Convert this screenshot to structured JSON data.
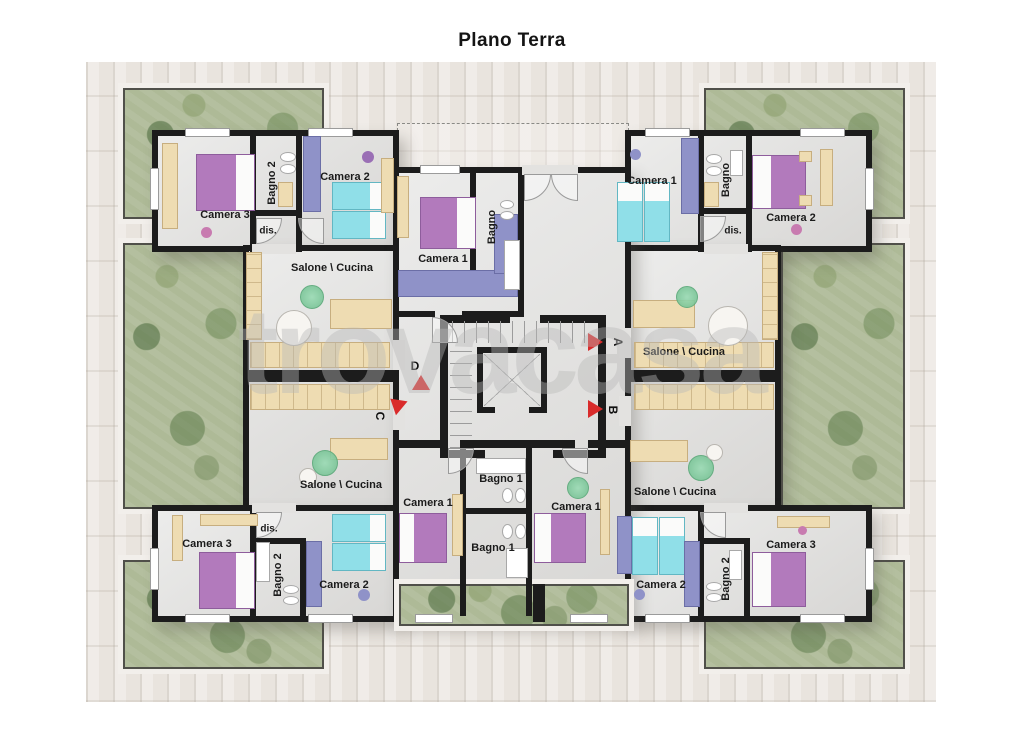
{
  "title": "Plano Terra",
  "watermark": "trovacasa",
  "markers": {
    "a": "A",
    "b": "B",
    "c": "C",
    "d": "D"
  },
  "rooms": {
    "top_left": {
      "camera3": "Camera 3",
      "bagno2": "Bagno 2",
      "camera2": "Camera 2",
      "dis": "dis.",
      "salone": "Salone \\ Cucina"
    },
    "top_center": {
      "camera1": "Camera 1",
      "bagno": "Bagno"
    },
    "top_right": {
      "camera1": "Camera 1",
      "bagno": "Bagno",
      "camera2": "Camera 2",
      "dis": "dis.",
      "salone": "Salone \\ Cucina"
    },
    "bottom_left": {
      "salone": "Salone \\ Cucina",
      "dis": "dis.",
      "camera3": "Camera 3",
      "bagno2": "Bagno 2",
      "camera2": "Camera 2"
    },
    "bottom_center": {
      "bagno1_top": "Bagno 1",
      "camera1_left": "Camera 1",
      "camera1_right": "Camera 1",
      "bagno1_bottom": "Bagno 1"
    },
    "bottom_right": {
      "salone": "Salone \\ Cucina",
      "camera2": "Camera 2",
      "bagno2": "Bagno 2",
      "camera3": "Camera 3"
    }
  },
  "colors": {
    "wall": "#1c1c1c",
    "floor": "#e6e5e3",
    "bed_purple": "#b27abc",
    "bed_cyan": "#90dfe8",
    "wardrobe_blue": "#8f92c8",
    "wood": "#eedcb2",
    "plant_green": "#83cfa2",
    "marker_red": "#d92b2b",
    "garden_green": "#aeba97",
    "paving": "#e9e4de"
  }
}
